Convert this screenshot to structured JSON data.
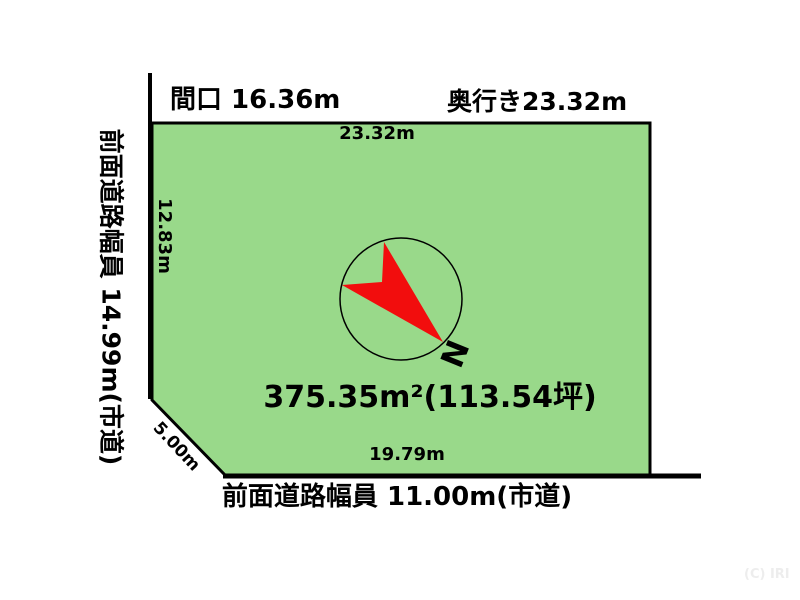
{
  "labels": {
    "frontage": "間口 16.36m",
    "depth": "奥行き23.32m",
    "top_dim": "23.32m",
    "left_dim": "12.83m",
    "left_road": "前面道路幅員 14.99m(市道)",
    "diagonal_dim": "5.00m",
    "bottom_dim": "19.79m",
    "area": "375.35m²(113.54坪)",
    "bottom_road": "前面道路幅員 11.00m(市道)",
    "watermark": "(C) IRI"
  },
  "compass": {
    "north_label": "N"
  },
  "colors": {
    "plot_fill": "#99d98a",
    "plot_border": "#000000",
    "road_line": "#000000",
    "compass_arrow": "#f20d0d",
    "compass_ring": "#000000",
    "watermark": "#ededed",
    "text": "#000000"
  }
}
